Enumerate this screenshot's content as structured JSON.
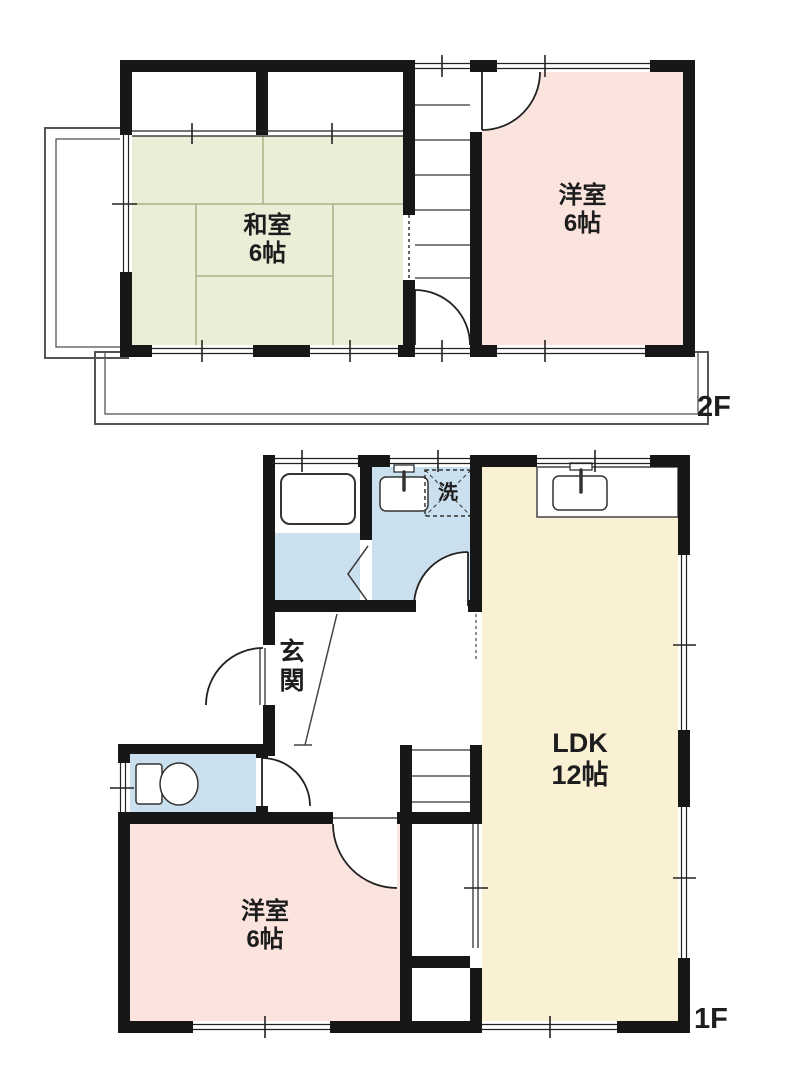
{
  "title": "2-story house floor plan",
  "floors": {
    "second": {
      "label": "2F",
      "rooms": {
        "washitsu": {
          "name": "和室",
          "size": "6帖"
        },
        "yoshitsu": {
          "name": "洋室",
          "size": "6帖"
        }
      },
      "features": [
        "closet",
        "stairs",
        "balcony-left",
        "balcony-bottom"
      ]
    },
    "first": {
      "label": "1F",
      "rooms": {
        "genkan": {
          "name": "玄関"
        },
        "laundry": {
          "name": "洗"
        },
        "ldk": {
          "name": "LDK",
          "size": "12帖"
        },
        "yoshitsu": {
          "name": "洋室",
          "size": "6帖"
        }
      },
      "features": [
        "bathtub",
        "washbasin",
        "toilet",
        "kitchen-sink",
        "stairs",
        "under-stairs-storage"
      ]
    }
  },
  "colors": {
    "wall": "#171717",
    "tatami_green": "#e9eed7",
    "room_pink": "#fce4de",
    "ldk_cream": "#faf0d4",
    "wet_blue": "#cbe0ef",
    "line": "#2e2e2e",
    "thin_gray": "#4a4a4a",
    "tatami_line": "#a9b185"
  }
}
